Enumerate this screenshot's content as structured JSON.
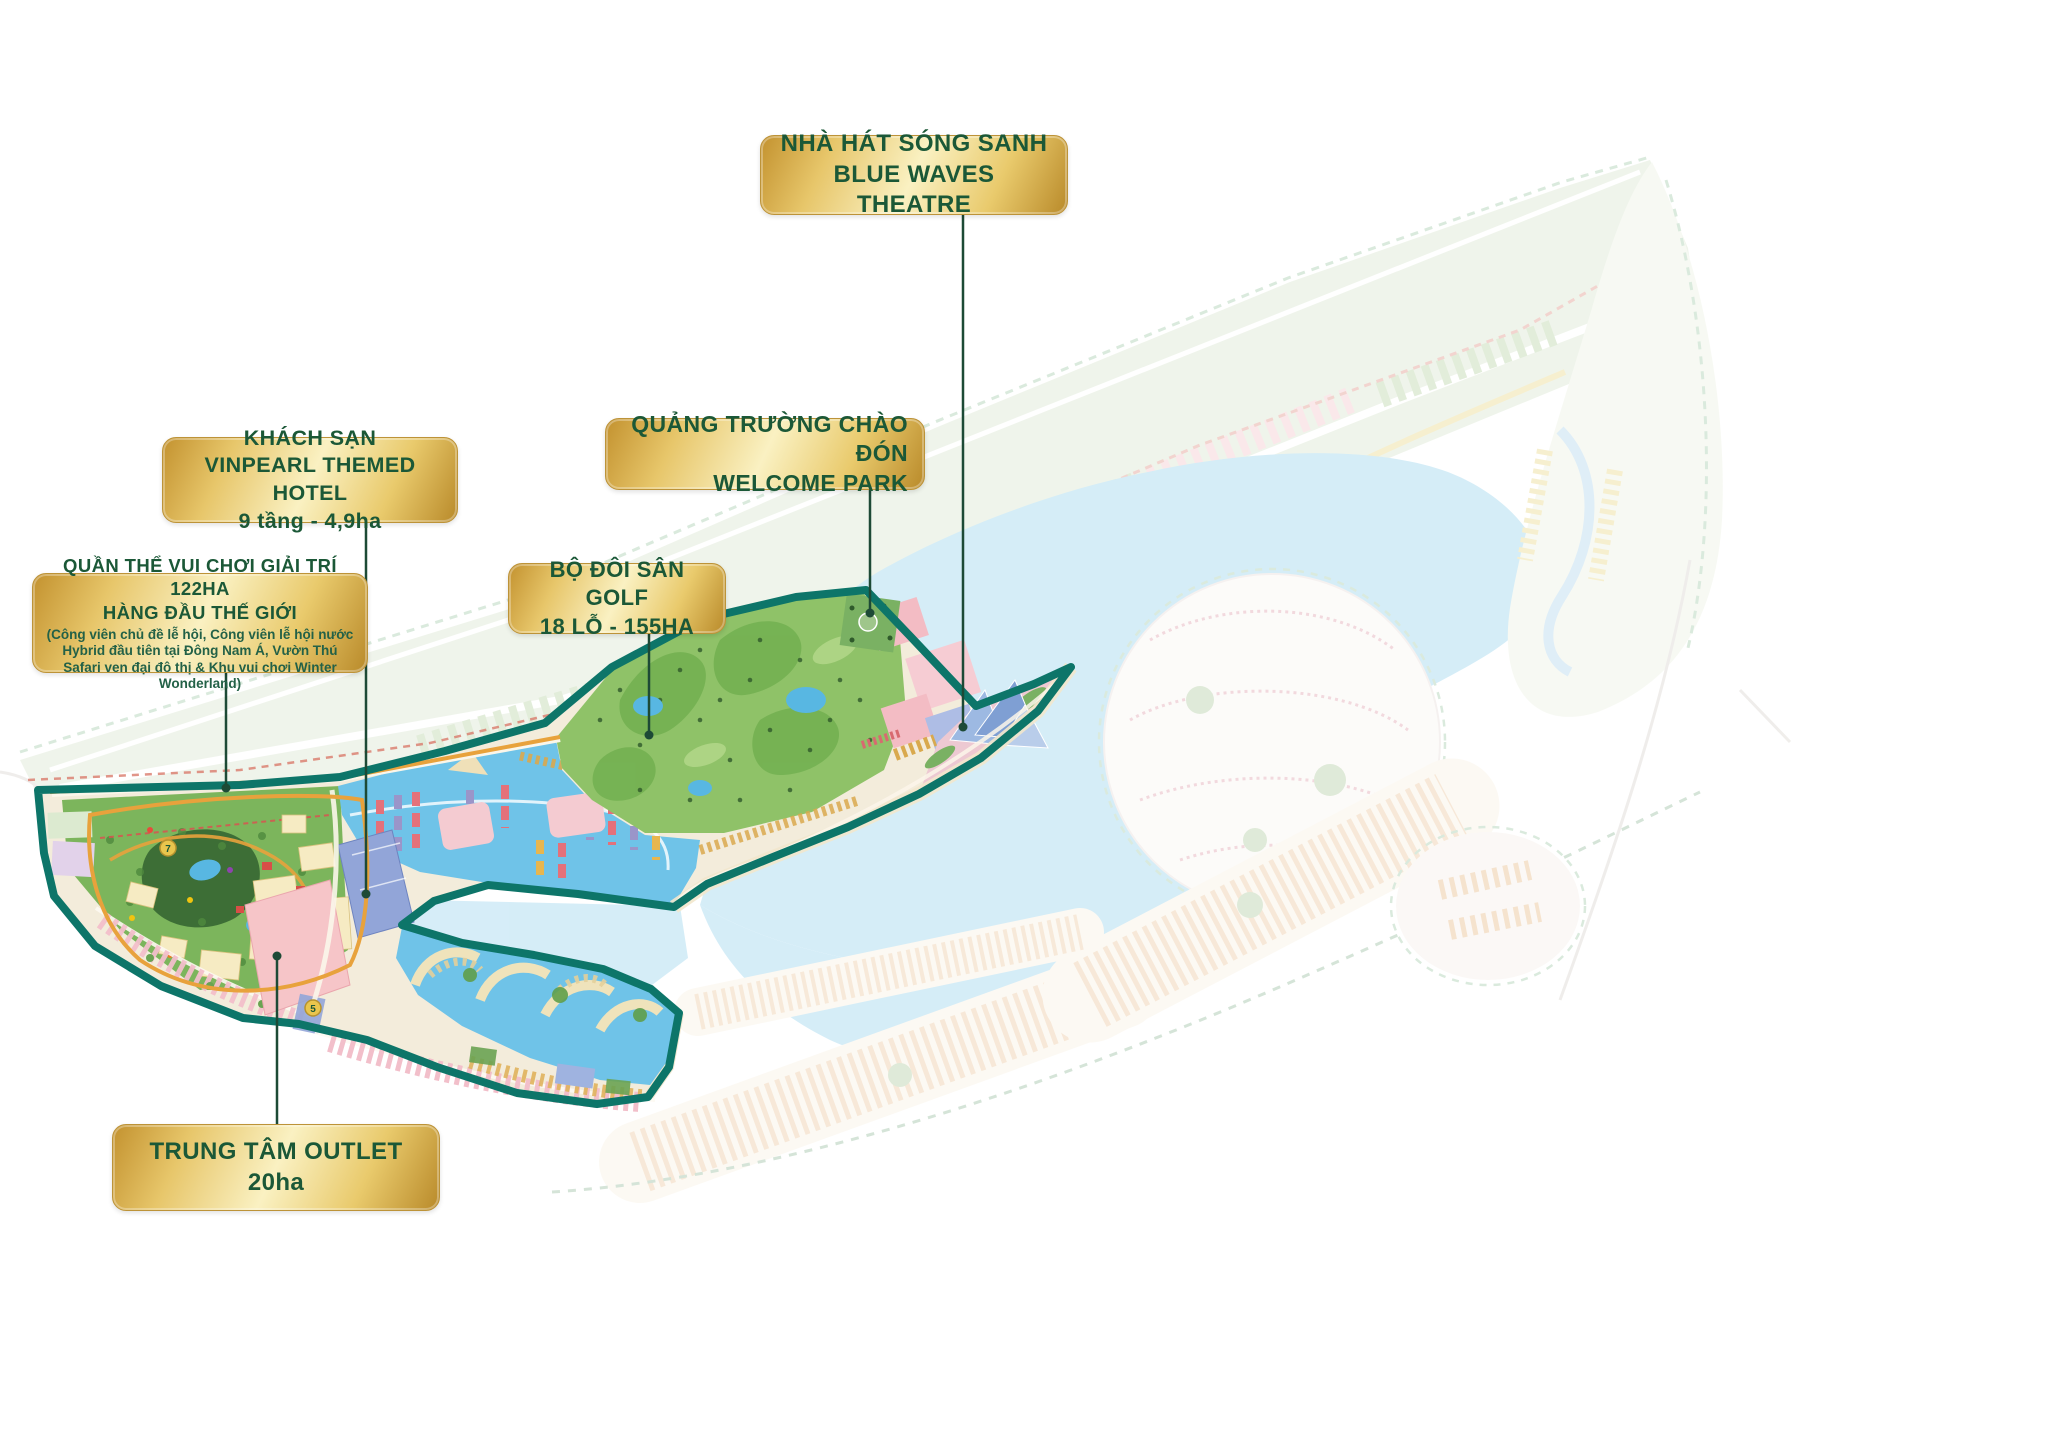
{
  "labels": {
    "theatre": {
      "line1": "NHÀ HÁT SÓNG SANH",
      "line2": "BLUE WAVES THEATRE"
    },
    "hotel": {
      "line1": "KHÁCH SẠN",
      "line2": "VINPEARL THEMED HOTEL",
      "line3": "9 tầng - 4,9ha"
    },
    "welcome": {
      "line1": "QUẢNG TRƯỜNG CHÀO ĐÓN",
      "line2": "WELCOME PARK"
    },
    "entertainment": {
      "line1": "QUẦN THỂ VUI CHƠI GIẢI TRÍ 122HA",
      "line2": "HÀNG ĐẦU THẾ GIỚI",
      "note": "(Công viên chủ đề lễ hội, Công viên lễ hội nước Hybrid đầu tiên tại Đông Nam Á, Vườn Thú Safari ven đại đô thị & Khu vui chơi Winter Wonderland)"
    },
    "golf": {
      "line1": "BỘ ĐÔI SÂN GOLF",
      "line2": "18 LỖ - 155HA"
    },
    "outlet": {
      "line1": "TRUNG TÂM OUTLET",
      "line2": "20ha"
    }
  },
  "map": {
    "markers": [
      "7",
      "5"
    ],
    "colors": {
      "highlight_outline": "#0d7569",
      "label_gold_dark": "#c3922f",
      "label_gold_light": "#faf1c2",
      "label_text_green": "#1b5837",
      "connector_green": "#1d4a36",
      "water_highlight": "#6fc3e8",
      "water_faded": "#cfe7f5",
      "golf_green": "#8fc268",
      "theme_park_green": "#7cb55c",
      "pink_block": "#f5c0c9",
      "hotel_blue": "#92a5d8",
      "sand": "#f2e7cc"
    }
  }
}
